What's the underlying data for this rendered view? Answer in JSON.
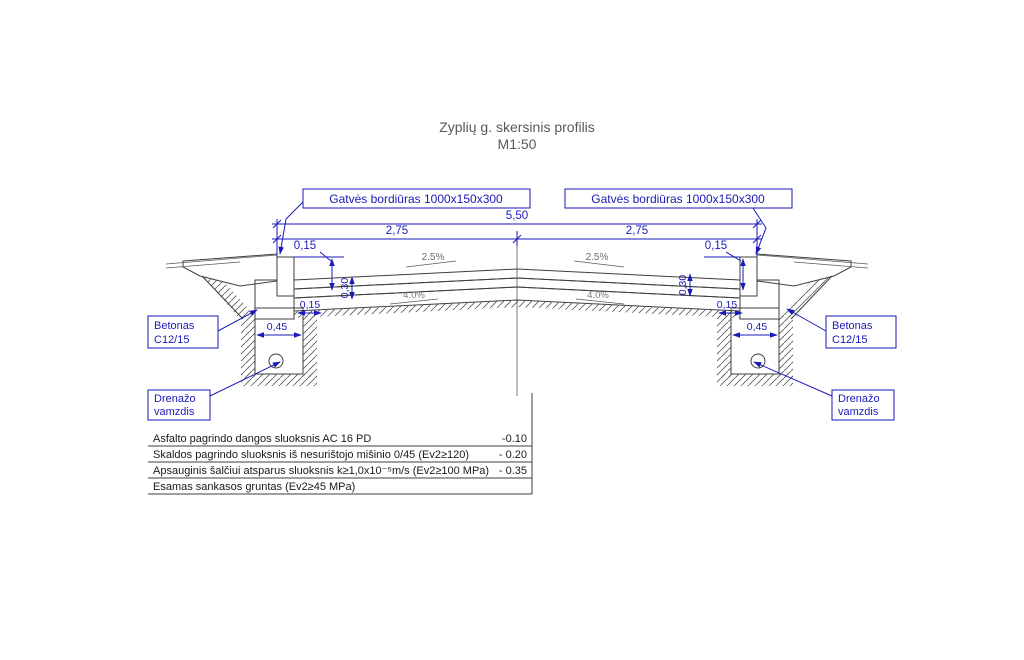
{
  "title": {
    "line1": "Zyplių g. skersinis profilis",
    "line2": "M1:50"
  },
  "callouts": {
    "curb": "Gatvės bordiūras 1000x150x300",
    "concrete_line1": "Betonas",
    "concrete_line2": "C12/15",
    "drain_line1": "Drenažo",
    "drain_line2": "vamzdis"
  },
  "dimensions": {
    "total_width": "5,50",
    "half_width": "2,75",
    "curb_reveal": "0,15",
    "structure_depth": "0,30",
    "foundation_offset": "0,15",
    "foundation_width": "0,45"
  },
  "slopes": {
    "cross_fall": "2.5%",
    "drainage_fall": "4.0%"
  },
  "layers_table": {
    "rows": [
      {
        "label": "Asfalto pagrindo dangos sluoksnis AC 16 PD",
        "depth": "-0.10"
      },
      {
        "label": "Skaldos pagrindo sluoksnis iš nesurištojo mišinio 0/45 (Ev2≥120)",
        "depth": "- 0.20"
      },
      {
        "label": "Apsauginis šalčiui atsparus sluoksnis k≥1,0x10⁻⁵m/s (Ev2≥100 MPa)",
        "depth": "- 0.35"
      },
      {
        "label": "Esamas sankasos gruntas (Ev2≥45 MPa)",
        "depth": ""
      }
    ]
  },
  "colors": {
    "dimension_blue": "#1a1ab9",
    "drawing_dark": "#3f3f3f",
    "title_gray": "#595959"
  }
}
